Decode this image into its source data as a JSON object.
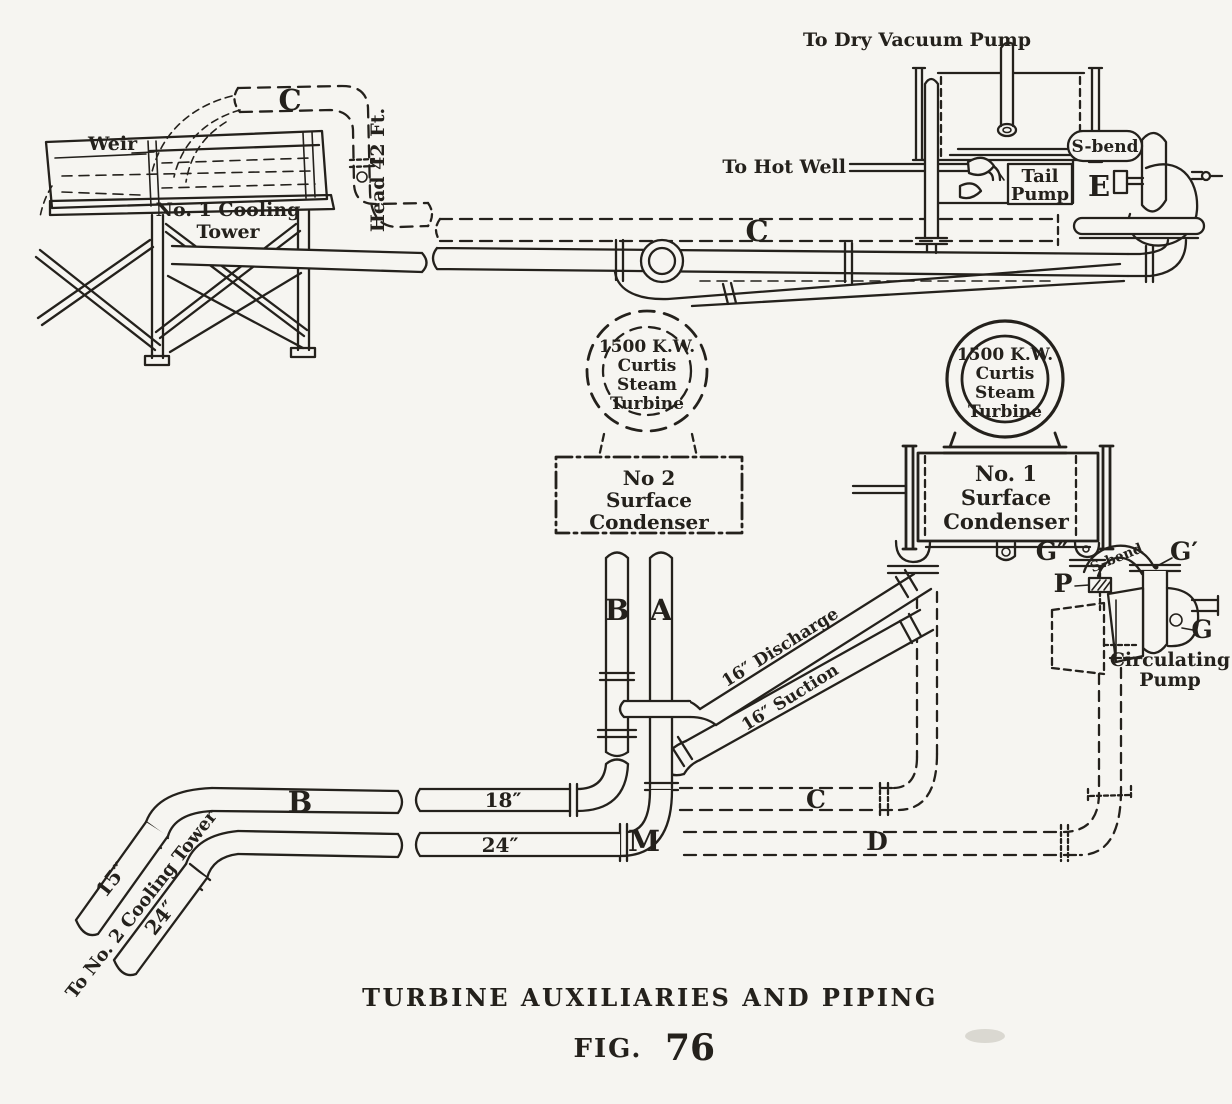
{
  "page": {
    "paper_color": "#f6f5f1",
    "ink_color": "#24211c"
  },
  "caption": {
    "title": "TURBINE AUXILIARIES AND PIPING",
    "fig_label": "FIG.",
    "fig_number": "76"
  },
  "cooling_tower": {
    "weir": "Weir",
    "name": [
      "No. 1 Cooling",
      "Tower"
    ],
    "riser_label": "C",
    "head_label": "Head 42 Ft."
  },
  "hotwell": {
    "to_dry_vacuum_pump": "To Dry Vacuum Pump",
    "to_hot_well": "To Hot Well",
    "tail_pump": [
      "Tail",
      "Pump"
    ],
    "s_bend": "S-bend",
    "pump_label": "E"
  },
  "main_line": {
    "label_c": "C"
  },
  "turbine": [
    "1500 K.W.",
    "Curtis",
    "Steam",
    "Turbine"
  ],
  "condenser_no2": [
    "No 2",
    "Surface",
    "Condenser"
  ],
  "condenser_no1": [
    "No. 1",
    "Surface",
    "Condenser"
  ],
  "circulating_pump": {
    "name": [
      "Circulating",
      "Pump"
    ],
    "g_double_prime": "G″",
    "g_prime": "G′",
    "g": "G",
    "p": "P",
    "s_bend": "S-bend"
  },
  "pipes": {
    "b_vertical": "B",
    "a_vertical": "A",
    "discharge": "16″ Discharge",
    "suction": "16″ Suction",
    "c_cold_main": "C",
    "d_main": "D",
    "b_horizontal": "B",
    "size_18": "18″",
    "size_24": "24″",
    "m_elbow": "M",
    "size_15": "15″",
    "size_24_branch": "24″",
    "to_no2_tower": "To No. 2 Cooling Tower"
  }
}
